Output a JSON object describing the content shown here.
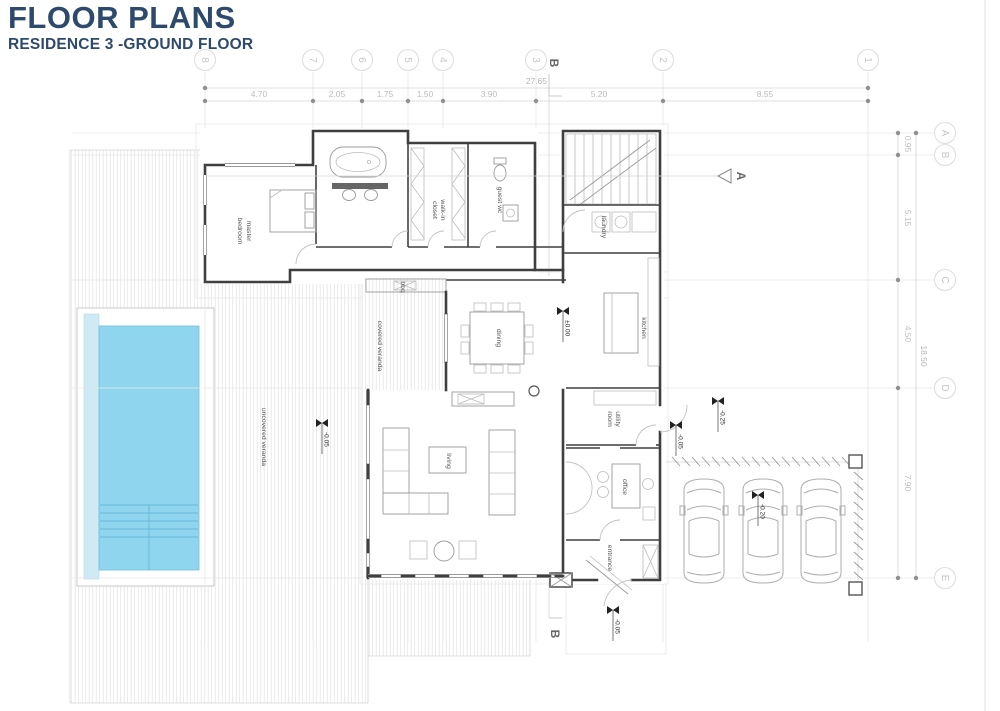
{
  "header": {
    "title": "FLOOR PLANS",
    "subtitle": "RESIDENCE 3 -GROUND FLOOR"
  },
  "grid": {
    "cols": [
      "8",
      "7",
      "6",
      "5",
      "4",
      "3",
      "2",
      "1"
    ],
    "rows": [
      "A",
      "B",
      "C",
      "D",
      "E"
    ]
  },
  "dims": {
    "top": [
      "4.70",
      "2.05",
      "1.75",
      "1.50",
      "3.90",
      "5.20",
      "8.55"
    ],
    "top_overall": "27.65",
    "right": [
      "0.95",
      "5.15",
      "4.50",
      "7.90"
    ],
    "right_overall": "18.50"
  },
  "sections": {
    "a": "A",
    "b_top": "B",
    "b_bottom": "B"
  },
  "rooms": [
    {
      "name": "master-bedroom",
      "lines": [
        "master",
        "bedroom"
      ]
    },
    {
      "name": "walk-in-closet",
      "lines": [
        "walk-in",
        "closet"
      ]
    },
    {
      "name": "guest-wc",
      "lines": [
        "guest wc"
      ]
    },
    {
      "name": "laundry",
      "lines": [
        "laundry"
      ]
    },
    {
      "name": "kitchen",
      "lines": [
        "kitchen"
      ]
    },
    {
      "name": "dining",
      "lines": [
        "dining"
      ]
    },
    {
      "name": "bbq",
      "lines": [
        "bbq"
      ]
    },
    {
      "name": "covered-veranda",
      "lines": [
        "covered veranda"
      ]
    },
    {
      "name": "uncovered-veranda",
      "lines": [
        "uncovered veranda"
      ]
    },
    {
      "name": "living",
      "lines": [
        "living"
      ]
    },
    {
      "name": "utility-room",
      "lines": [
        "utility",
        "room"
      ]
    },
    {
      "name": "office",
      "lines": [
        "office"
      ]
    },
    {
      "name": "entrance",
      "lines": [
        "entrance"
      ]
    }
  ],
  "levels": [
    "±0.00",
    "-0.05",
    "-0.25",
    "-0.05",
    "-0.20",
    "-0.05"
  ],
  "colors": {
    "accent": "#2d4a6d",
    "walls": "#3f3f3f",
    "pool_water": "#8fd5ee",
    "pool_edge": "#cfe9f5"
  }
}
